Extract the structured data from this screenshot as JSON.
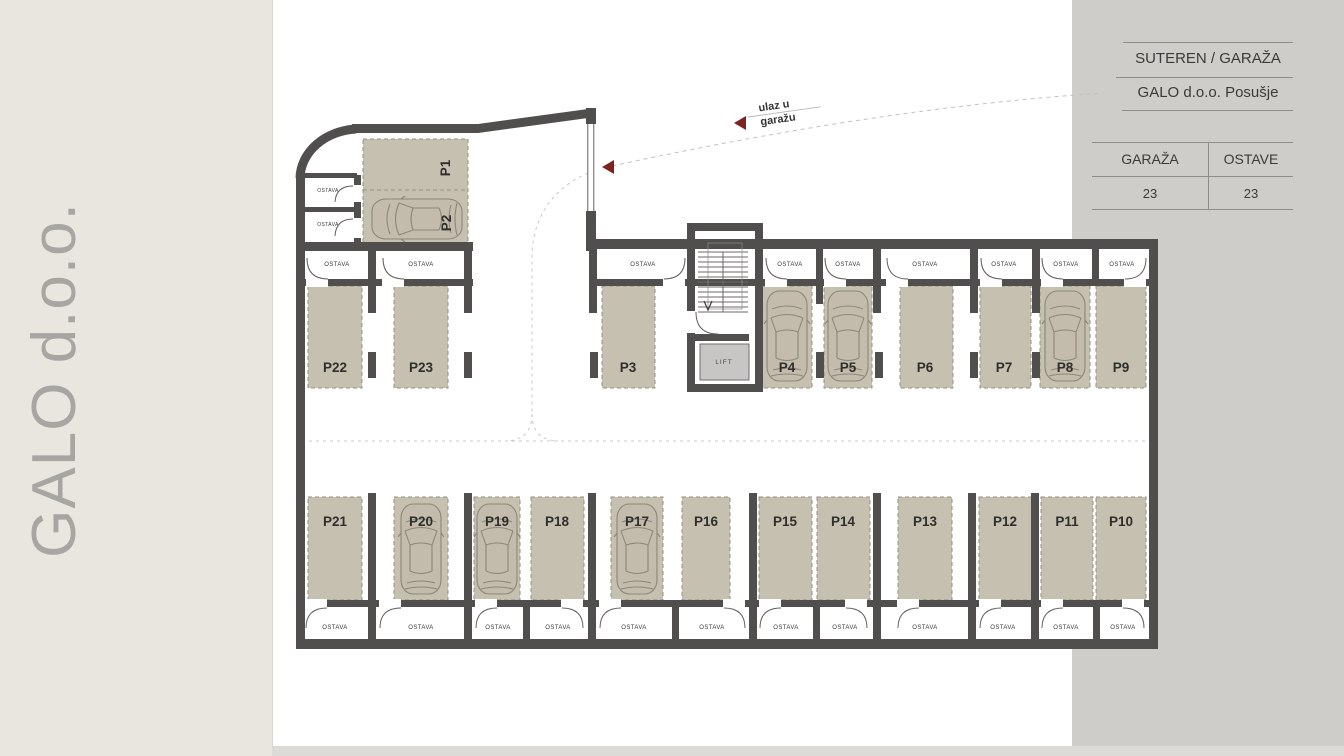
{
  "brand": "GALO d.o.o.",
  "legend": {
    "title": "SUTEREN / GARAŽA",
    "subtitle": "GALO d.o.o. Posušje",
    "table": {
      "col1_header": "GARAŽA",
      "col2_header": "OSTAVE",
      "col1_value": "23",
      "col2_value": "23"
    }
  },
  "annotations": {
    "entrance_line1": "ulaz u",
    "entrance_line2": "garažu"
  },
  "plan": {
    "lift_label": "LIFT",
    "ostava_label": "OSTAVA",
    "stalls": [
      "P1",
      "P2",
      "P3",
      "P4",
      "P5",
      "P6",
      "P7",
      "P8",
      "P9",
      "P10",
      "P11",
      "P12",
      "P13",
      "P14",
      "P15",
      "P16",
      "P17",
      "P18",
      "P19",
      "P20",
      "P21",
      "P22",
      "P23"
    ]
  },
  "colors": {
    "wall": "#504f4d",
    "stall_fill": "#c6c0b1",
    "accent_red": "#7c2422",
    "page_beige": "#e9e6df",
    "panel_gray": "#cecdca"
  }
}
